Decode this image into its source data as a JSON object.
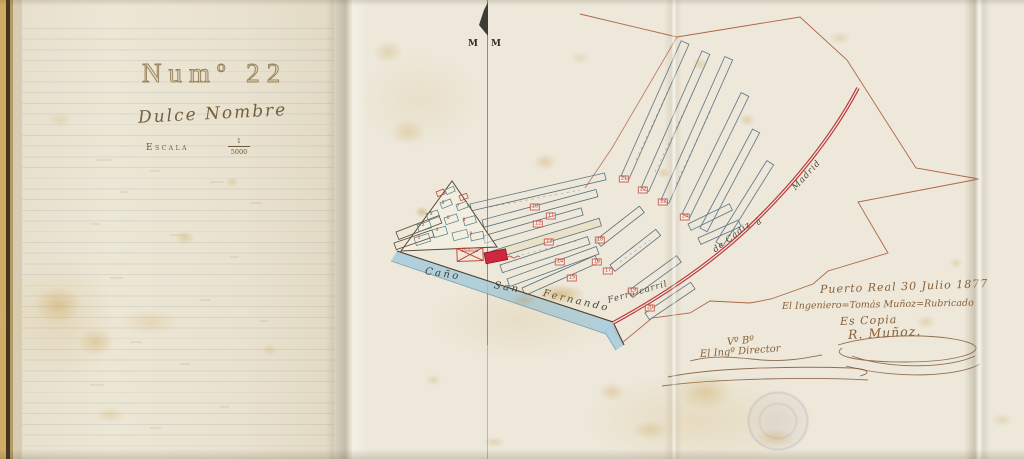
{
  "left_page": {
    "number": "Numº 22",
    "title": "Dulce Nombre",
    "scale_label": "Escala",
    "scale_numerator": "1",
    "scale_denominator": "5000"
  },
  "map": {
    "meridian_letter_left": "M",
    "meridian_letter_right": "M",
    "building_label": "Bodega",
    "labels": [
      {
        "name": "water-label-cano",
        "cls": "water",
        "text": "Caño",
        "x": 425,
        "y": 266,
        "rot": 9
      },
      {
        "name": "water-label-san",
        "cls": "water",
        "text": "San",
        "x": 494,
        "y": 280,
        "rot": 10
      },
      {
        "name": "water-label-fernando",
        "cls": "water",
        "text": "Fernando",
        "x": 543,
        "y": 288,
        "rot": 13
      },
      {
        "name": "railway-label-ferrocarril",
        "cls": "rail",
        "text": "Ferro-carril",
        "x": 608,
        "y": 296,
        "rot": -16
      },
      {
        "name": "railway-label-decadiz",
        "cls": "rail",
        "text": "de Cádiz",
        "x": 714,
        "y": 246,
        "rot": -37
      },
      {
        "name": "railway-label-a",
        "cls": "rail",
        "text": "á",
        "x": 757,
        "y": 219,
        "rot": -40
      },
      {
        "name": "railway-label-madrid",
        "cls": "rail",
        "text": "Madrid",
        "x": 794,
        "y": 184,
        "rot": -47
      }
    ],
    "markers": [
      {
        "n": "1",
        "x": 419,
        "y": 239
      },
      {
        "n": "2",
        "x": 423,
        "y": 226
      },
      {
        "n": "3",
        "x": 431,
        "y": 215
      },
      {
        "n": "4",
        "x": 437,
        "y": 231
      },
      {
        "n": "5",
        "x": 443,
        "y": 204
      },
      {
        "n": "6",
        "x": 448,
        "y": 219
      },
      {
        "n": "7",
        "x": 458,
        "y": 207
      },
      {
        "n": "8",
        "x": 464,
        "y": 221
      },
      {
        "n": "9",
        "x": 471,
        "y": 235
      },
      {
        "n": "10",
        "x": 535,
        "y": 207,
        "boxed": true
      },
      {
        "n": "11",
        "x": 551,
        "y": 216,
        "boxed": true
      },
      {
        "n": "12",
        "x": 538,
        "y": 224,
        "boxed": true
      },
      {
        "n": "13",
        "x": 549,
        "y": 242,
        "boxed": true
      },
      {
        "n": "14",
        "x": 560,
        "y": 262,
        "boxed": true
      },
      {
        "n": "15",
        "x": 572,
        "y": 278,
        "boxed": true
      },
      {
        "n": "16",
        "x": 597,
        "y": 262,
        "boxed": true
      },
      {
        "n": "17",
        "x": 608,
        "y": 271,
        "boxed": true
      },
      {
        "n": "18",
        "x": 600,
        "y": 240,
        "boxed": true
      },
      {
        "n": "19",
        "x": 633,
        "y": 291,
        "boxed": true
      },
      {
        "n": "20",
        "x": 650,
        "y": 308,
        "boxed": true
      },
      {
        "n": "21",
        "x": 624,
        "y": 179,
        "boxed": true
      },
      {
        "n": "22",
        "x": 643,
        "y": 190,
        "boxed": true
      },
      {
        "n": "23",
        "x": 663,
        "y": 202,
        "boxed": true
      },
      {
        "n": "24",
        "x": 685,
        "y": 217,
        "boxed": true
      }
    ]
  },
  "attestation": {
    "place_date": "Puerto Real 30 Julio 1877",
    "engineer_line": "El Ingeniero=Tomás Muñoz=Rubricado",
    "copy_note": "Es Copia",
    "signature": "R. Muñoz.",
    "approval_mark": "Vº Bº",
    "approver_title": "El Ingº Director"
  }
}
